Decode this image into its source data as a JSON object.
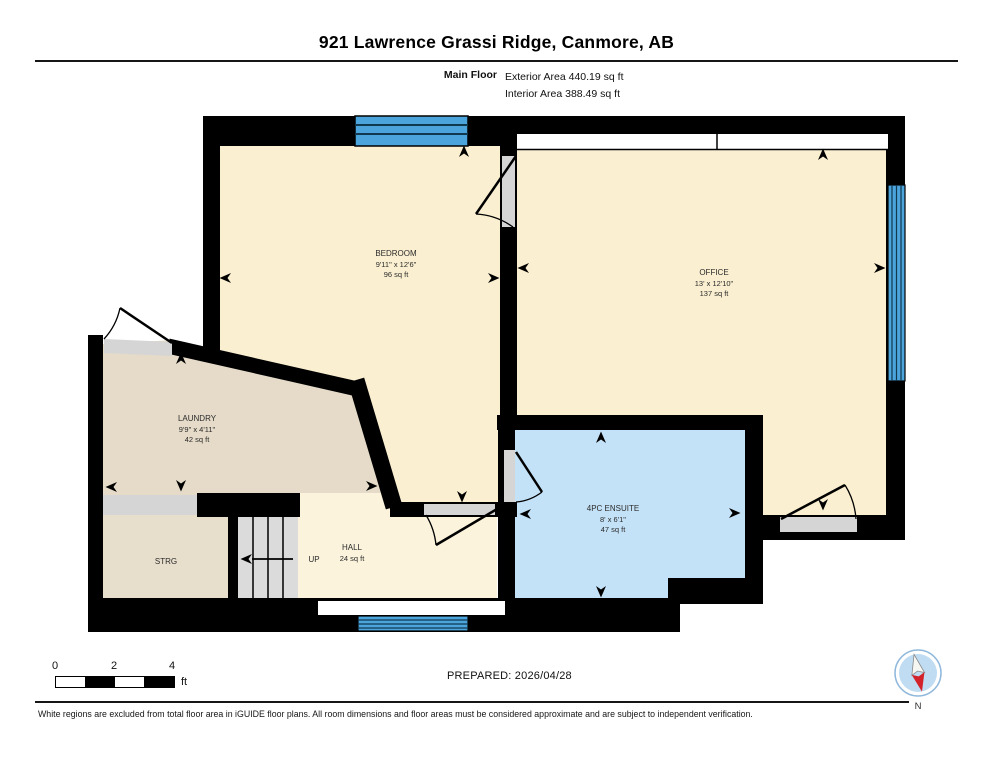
{
  "header": {
    "title": "921 Lawrence Grassi Ridge, Canmore, AB",
    "floor_label": "Main Floor",
    "exterior_area": "Exterior Area 440.19 sq ft",
    "interior_area": "Interior Area 388.49 sq ft"
  },
  "plan": {
    "rooms": {
      "bedroom": {
        "name": "BEDROOM",
        "dims": "9'11\" x 12'6\"",
        "area": "96 sq ft"
      },
      "office": {
        "name": "OFFICE",
        "dims": "13' x 12'10\"",
        "area": "137 sq ft"
      },
      "laundry": {
        "name": "LAUNDRY",
        "dims": "9'9\" x 4'11\"",
        "area": "42 sq ft"
      },
      "ensuite": {
        "name": "4PC ENSUITE",
        "dims": "8' x 6'1\"",
        "area": "47 sq ft"
      },
      "storage": {
        "name": "STRG"
      },
      "hall": {
        "name": "HALL",
        "area": "24 sq ft"
      },
      "stairs": {
        "label": "UP"
      }
    }
  },
  "footer": {
    "scale_ticks": [
      "0",
      "2",
      "4"
    ],
    "scale_unit": "ft",
    "prepared": "PREPARED: 2026/04/28",
    "compass": "N",
    "disclaimer": "White regions are excluded from total floor area in iGUIDE floor plans. All room dimensions and floor areas must be considered approximate and are subject to independent verification."
  },
  "colors": {
    "wall": "#000000",
    "room_floor": "#FAEFD0",
    "hall_floor": "#FBF3DC",
    "laundry_floor": "#E5DBC8",
    "ensuite_floor": "#C4E2F7",
    "window": "#4BA4DB",
    "stairs": "#DBDBDB",
    "door_opening": "#D5D5D5",
    "compass_red": "#D3222A"
  }
}
